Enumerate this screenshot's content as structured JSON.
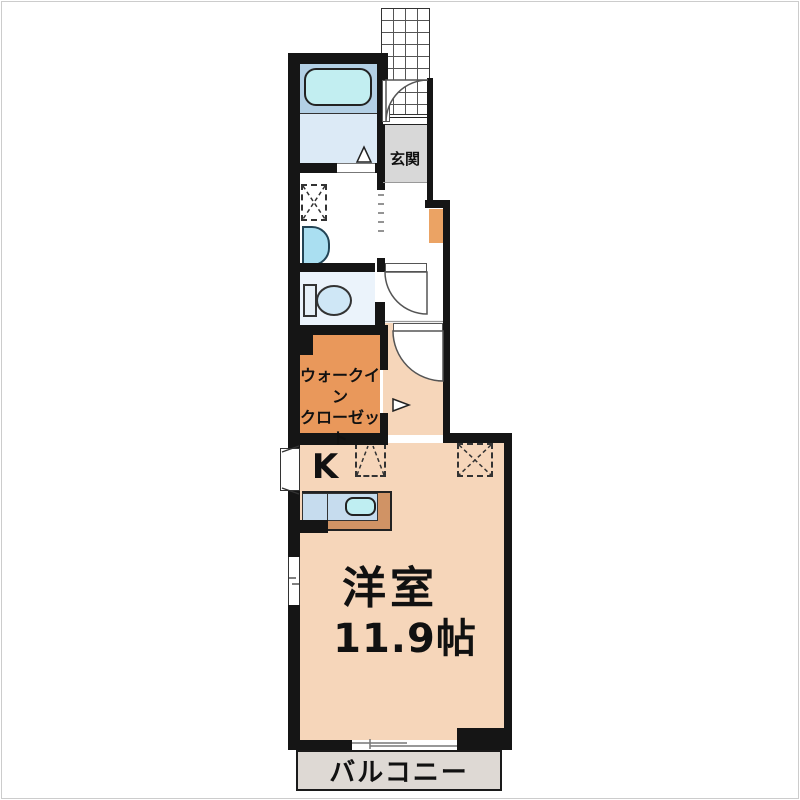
{
  "plan": {
    "type": "apartment-floor-plan",
    "labels": {
      "entrance": "玄関",
      "walk_in_closet_line1": "ウォークイン",
      "walk_in_closet_line2": "クローゼット",
      "kitchen": "K",
      "main_room_name": "洋室",
      "main_room_size": "11.9帖",
      "balcony": "バルコニー"
    },
    "rooms": [
      {
        "name": "bathroom",
        "features": [
          "bathtub"
        ]
      },
      {
        "name": "washroom",
        "features": [
          "washing-machine-space",
          "sink"
        ]
      },
      {
        "name": "toilet-room",
        "features": [
          "toilet"
        ]
      },
      {
        "name": "entrance",
        "label": "玄関"
      },
      {
        "name": "walk-in-closet",
        "label": "ウォークイン クローゼット"
      },
      {
        "name": "kitchen",
        "label": "K",
        "features": [
          "counter-with-sink",
          "refrigerator-space",
          "appliance-space"
        ]
      },
      {
        "name": "western-room",
        "label": "洋室",
        "size": "11.9帖"
      },
      {
        "name": "balcony",
        "label": "バルコニー"
      }
    ],
    "colors": {
      "wall": "#151515",
      "main_floor": "#f6d6ba",
      "closet_orange": "#e9985b",
      "shoebox_orange": "#eba364",
      "bath_upper": "#b3d0e5",
      "bath_lower": "#dceaf6",
      "bathtub": "#c2eef1",
      "toilet_floor": "#ebf3fb",
      "toilet_bowl": "#cfe7f6",
      "sink_blue": "#aadff1",
      "counter_frame": "#d09365",
      "counter_inner": "#c6dcee",
      "counter_sink": "#bfeef2",
      "entrance_floor": "#d8d8d8",
      "balcony_floor": "#ded9d4"
    }
  }
}
